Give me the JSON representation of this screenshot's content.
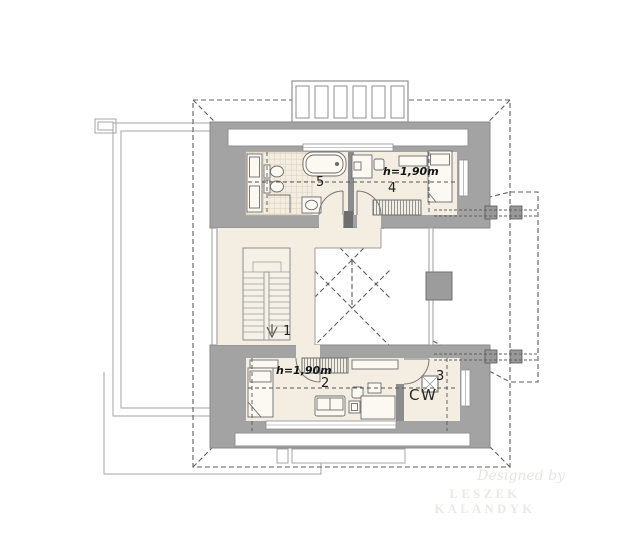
{
  "plan": {
    "room_labels": {
      "r1": "1",
      "r2": "2",
      "r3": "3",
      "r4": "4",
      "r5": "5"
    },
    "height_note_top": "h=1,90m",
    "height_note_bottom": "h=1,90m",
    "closet_label": "CW"
  },
  "watermark": {
    "line1": "Designed by",
    "line2": "LESZEK KALANDYK"
  },
  "colors": {
    "wall_gray": "#a3a3a3",
    "inner_wall_gray": "#8c8c8c",
    "floor_beige": "#f4eee2",
    "tile_line": "#e0d3bd",
    "dashed_roof": "#5f5f5f",
    "thin_outline": "#a6a6a6",
    "watermark": "#ebe9e4"
  }
}
